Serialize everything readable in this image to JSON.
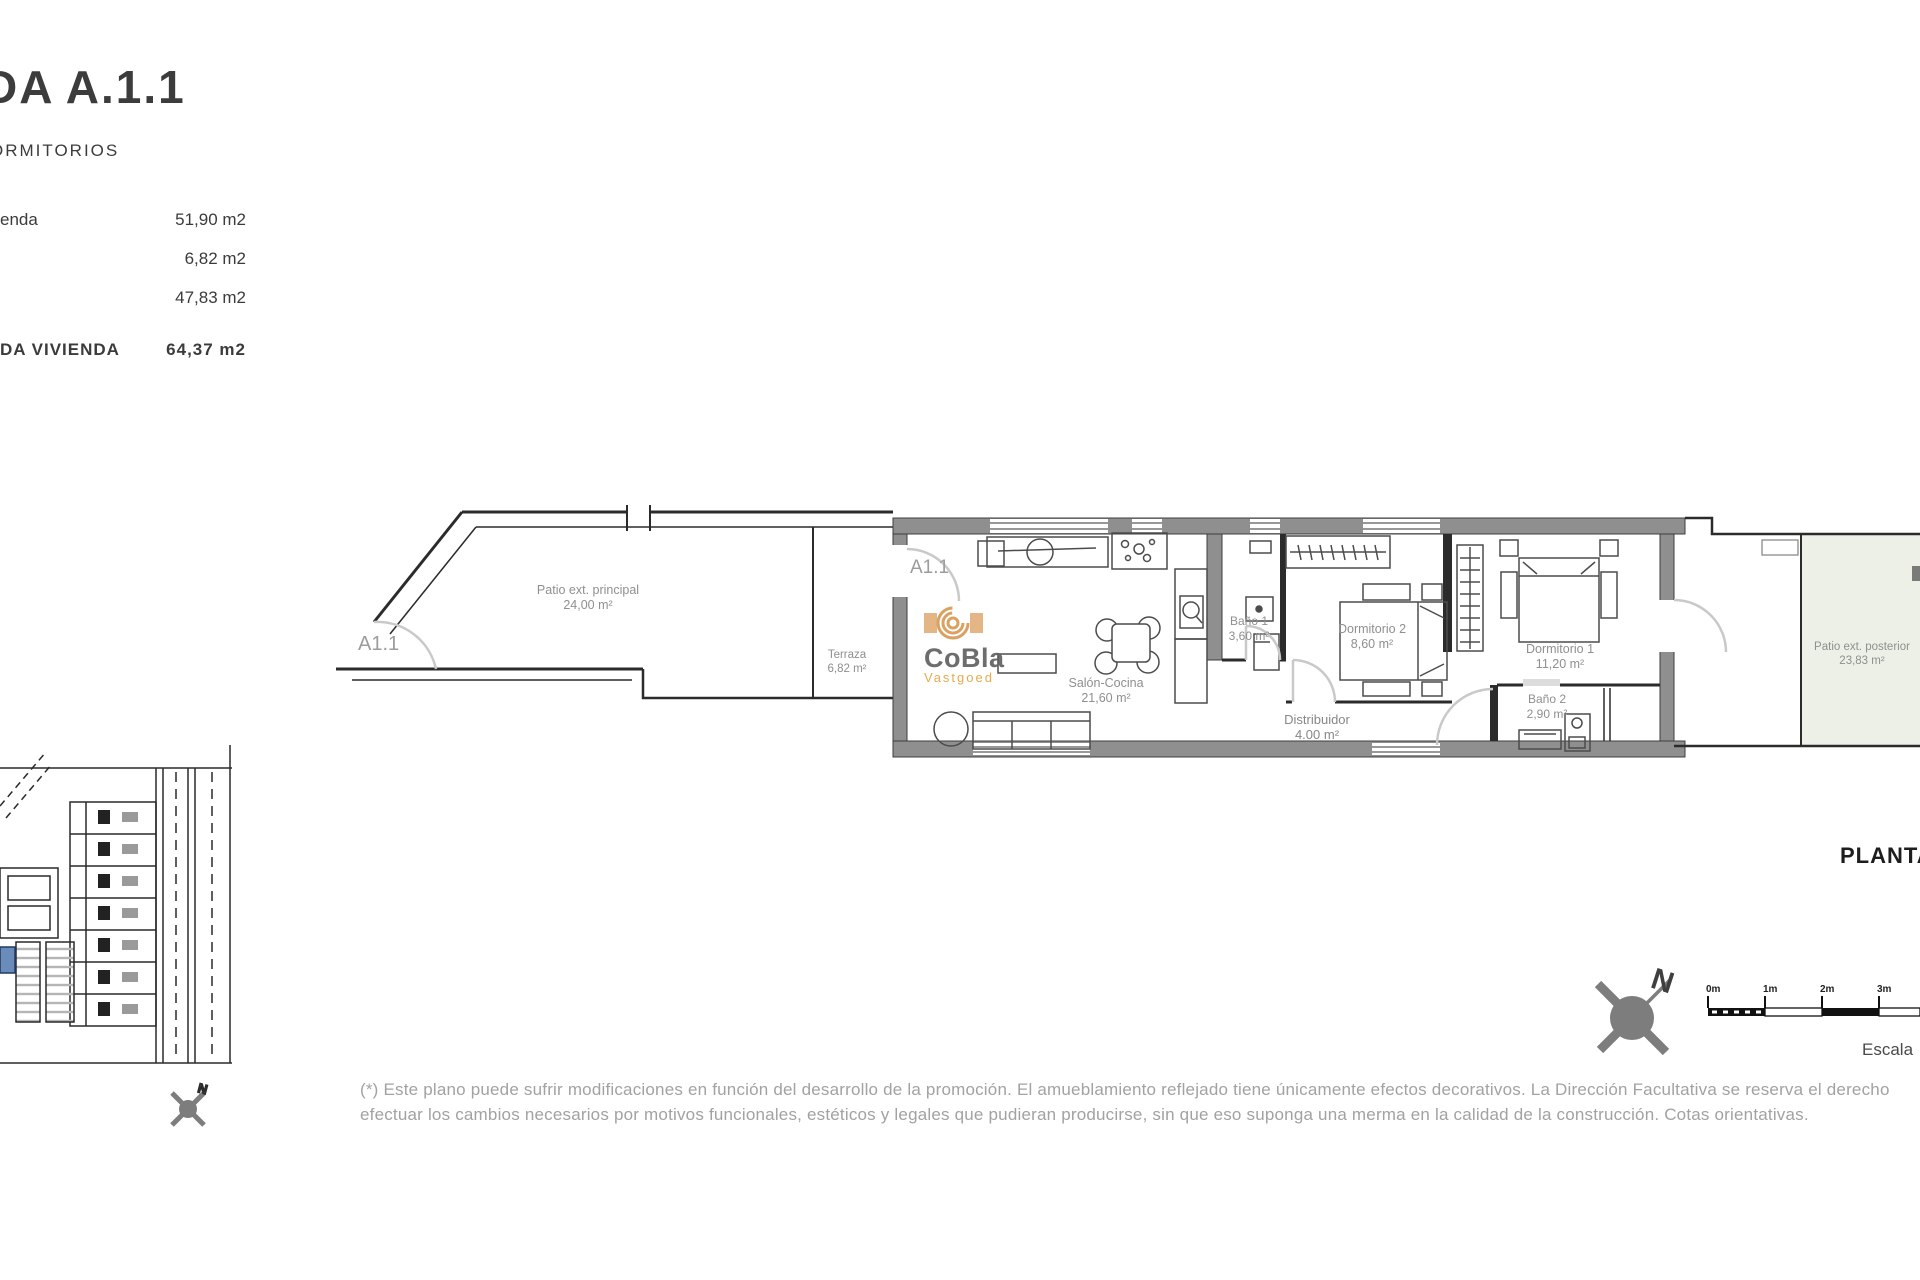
{
  "header": {
    "title": "DA A.1.1",
    "subtitle": "ORMITORIOS",
    "area_rows": [
      {
        "label": "enda",
        "value": "51,90 m2"
      },
      {
        "label": "",
        "value": "6,82 m2"
      },
      {
        "label": "",
        "value": "47,83 m2"
      }
    ],
    "total_row": {
      "label": "DA VIVIENDA",
      "value": "64,37 m2"
    }
  },
  "plan": {
    "unit_patio_label": "A1.1",
    "unit_entrance_label": "A1.1",
    "rooms": [
      {
        "name": "Patio ext. principal",
        "area": "24,00 m²"
      },
      {
        "name": "Terraza",
        "area": "6,82 m²"
      },
      {
        "name": "Salón-Cocina",
        "area": "21,60 m²"
      },
      {
        "name": "Baño 1",
        "area": "3,60 m²"
      },
      {
        "name": "Dormitorio 2",
        "area": "8,60 m²"
      },
      {
        "name": "Distribuidor",
        "area": "4.00 m²"
      },
      {
        "name": "Dormitorio 1",
        "area": "11,20 m²"
      },
      {
        "name": "Baño 2",
        "area": "2,90 m²"
      },
      {
        "name": "Patio ext. posterior",
        "area": "23,83 m²"
      }
    ],
    "watermark": {
      "brand": "CoBla",
      "sub": "Vastgoed"
    }
  },
  "footer": {
    "plan_title": "PLANTA",
    "scale_word": "Escala",
    "scale_ticks": [
      "0m",
      "1m",
      "2m",
      "3m"
    ],
    "north_letter": "N",
    "disclaimer_line1": "(*) Este plano puede sufrir modificaciones en función del desarrollo de la promoción. El amueblamiento reflejado tiene únicamente efectos decorativos. La Dirección Facultativa se reserva el derecho",
    "disclaimer_line2": "efectuar los cambios necesarios por motivos funcionales, estéticos y legales que pudieran producirse, sin que eso suponga una merma en la calidad de la construcción. Cotas orientativas."
  },
  "colors": {
    "wall_gray": "#8f8f8f",
    "patio_green": "#edf0e6",
    "logo_orange": "#dfa463",
    "logo_text_gray": "#616161",
    "highlight_blue": "#6b8cba"
  }
}
